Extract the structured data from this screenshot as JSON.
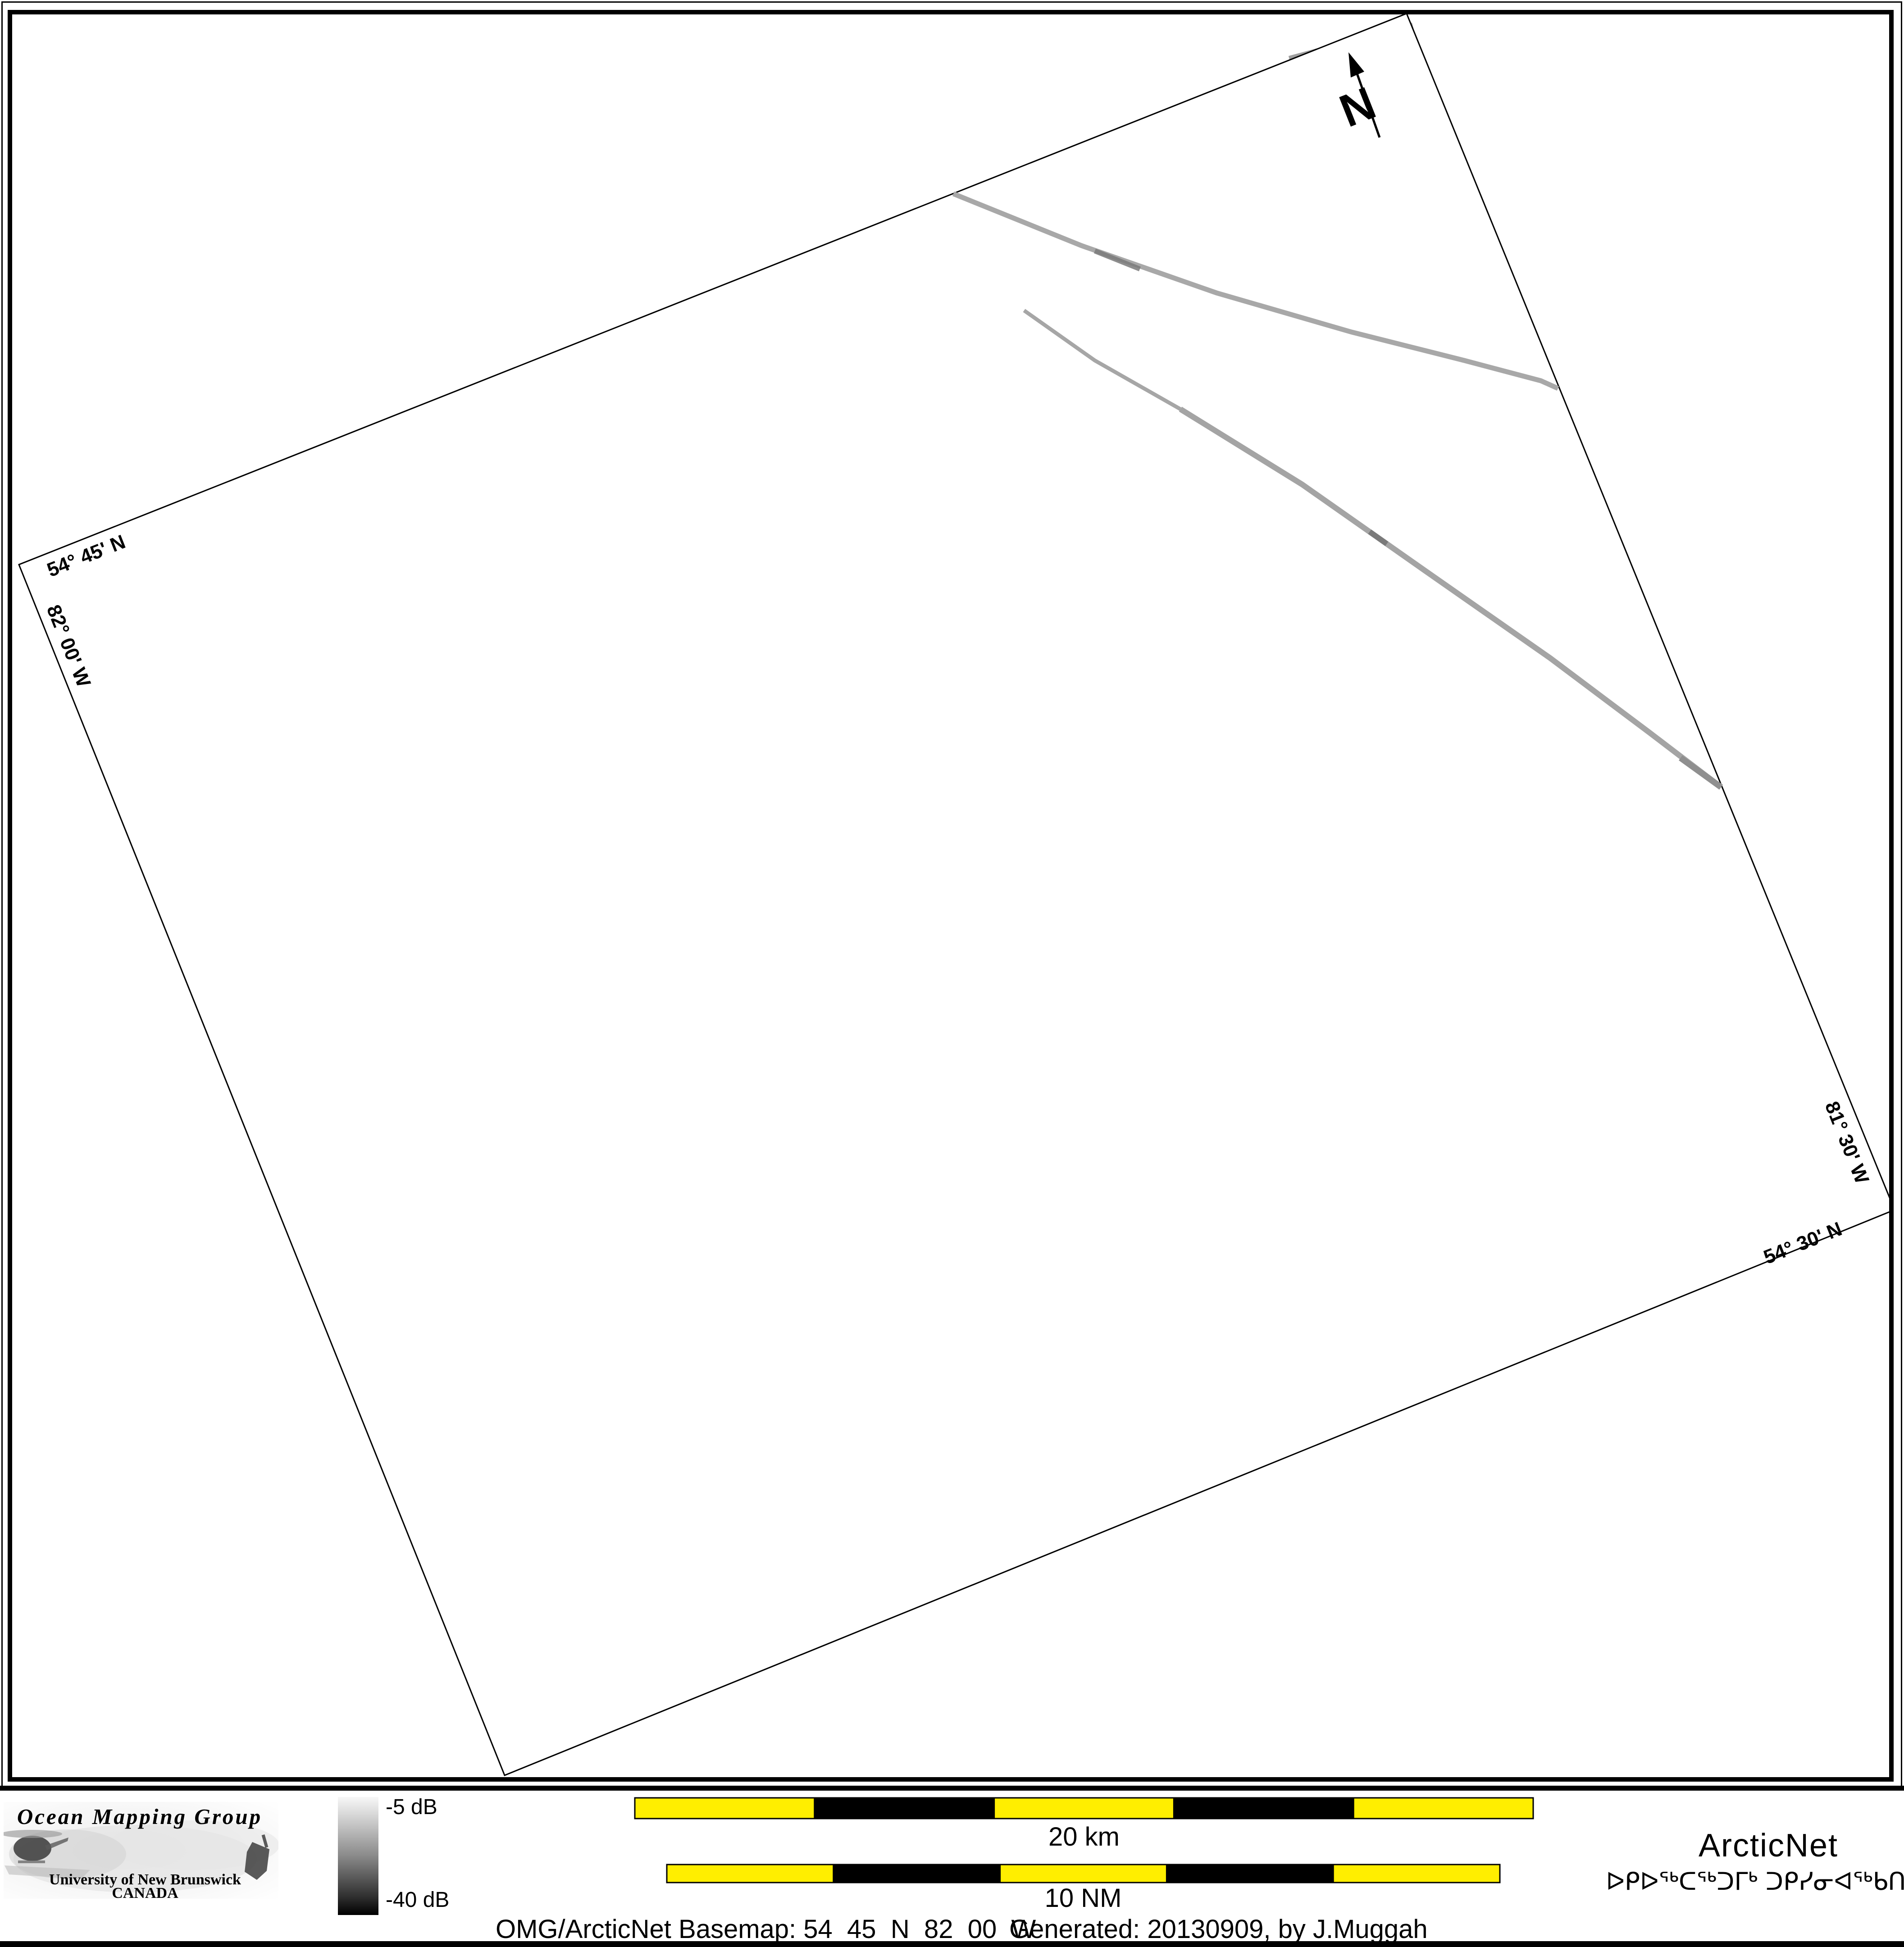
{
  "map": {
    "graticule": {
      "lat_top_left": "54° 45' N",
      "lon_left": "82° 00' W",
      "lon_right": "81° 30' W",
      "lat_bottom_right": "54° 30' N"
    },
    "north_arrow_label": "N"
  },
  "legend": {
    "colorbar_max_label": "-5 dB",
    "colorbar_min_label": "-40 dB",
    "scalebar_km_label": "20 km",
    "scalebar_nm_label": "10 NM"
  },
  "footer": {
    "caption_basemap": "OMG/ArcticNet Basemap: 54_45_N_82_00_W",
    "caption_generated": "Generated: 20130909, by J.Muggah"
  },
  "logos": {
    "omg": {
      "title": "Ocean Mapping Group",
      "subtitle": "University of New Brunswick",
      "country": "CANADA"
    },
    "arcticnet": {
      "name": "ArcticNet",
      "inuktitut_name": "ᐅᑭᐅᖅᑕᖅᑐᒥᒃ ᑐᑭᓯᓂᐊᖅᑲᑎᒌᑦ"
    }
  },
  "colors": {
    "scalebar_yellow": "#FFEE00",
    "omg_red": "#A31218",
    "omg_blue": "#1F1F9C",
    "arcticnet_blue": "#8CB5E2",
    "arcticnet_navy": "#334459",
    "survey_line_gray": "#A8A8A8",
    "colorbar_top": "#F7F7F7",
    "colorbar_bottom": "#000000"
  }
}
